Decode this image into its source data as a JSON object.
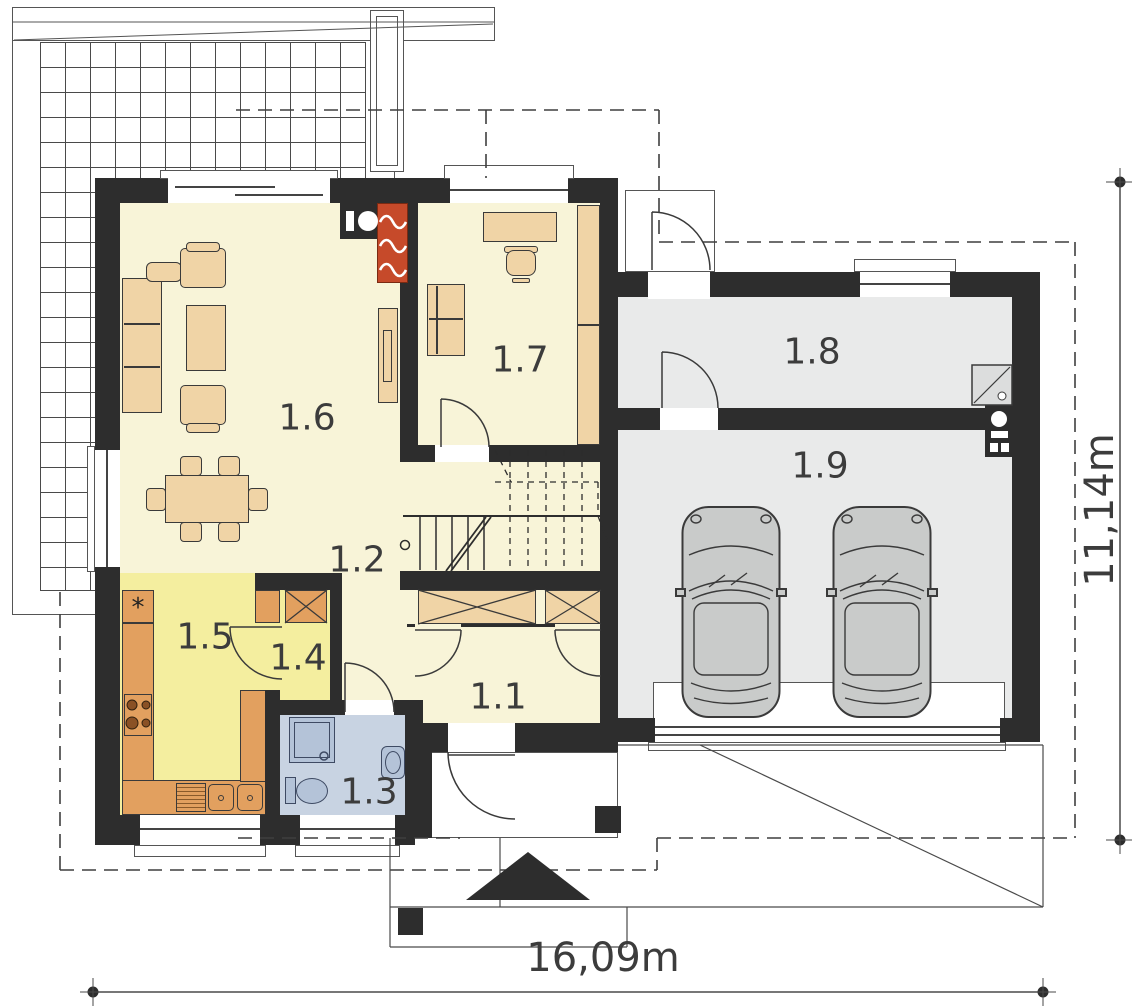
{
  "rooms": {
    "r1_1": {
      "label": "1.1"
    },
    "r1_2": {
      "label": "1.2"
    },
    "r1_3": {
      "label": "1.3"
    },
    "r1_4": {
      "label": "1.4"
    },
    "r1_5": {
      "label": "1.5"
    },
    "r1_6": {
      "label": "1.6"
    },
    "r1_7": {
      "label": "1.7"
    },
    "r1_8": {
      "label": "1.8"
    },
    "r1_9": {
      "label": "1.9"
    }
  },
  "dimensions": {
    "width_label": "16,09m",
    "height_label": "11,14m"
  },
  "kitchen": {
    "fridge_symbol": "*"
  },
  "colors": {
    "wall": "#2d2d2d",
    "room_cream": "#f8f4d8",
    "kitchen_yellow": "#f4ee9f",
    "counter_orange": "#e2a05f",
    "furniture_tan": "#f0d4a6",
    "fireplace_red": "#c64a2a",
    "bath_blue": "#c8d3e2",
    "fixture_blue": "#b4c3d8",
    "garage_gray": "#e9eaea",
    "car_gray": "#c9cbca"
  }
}
